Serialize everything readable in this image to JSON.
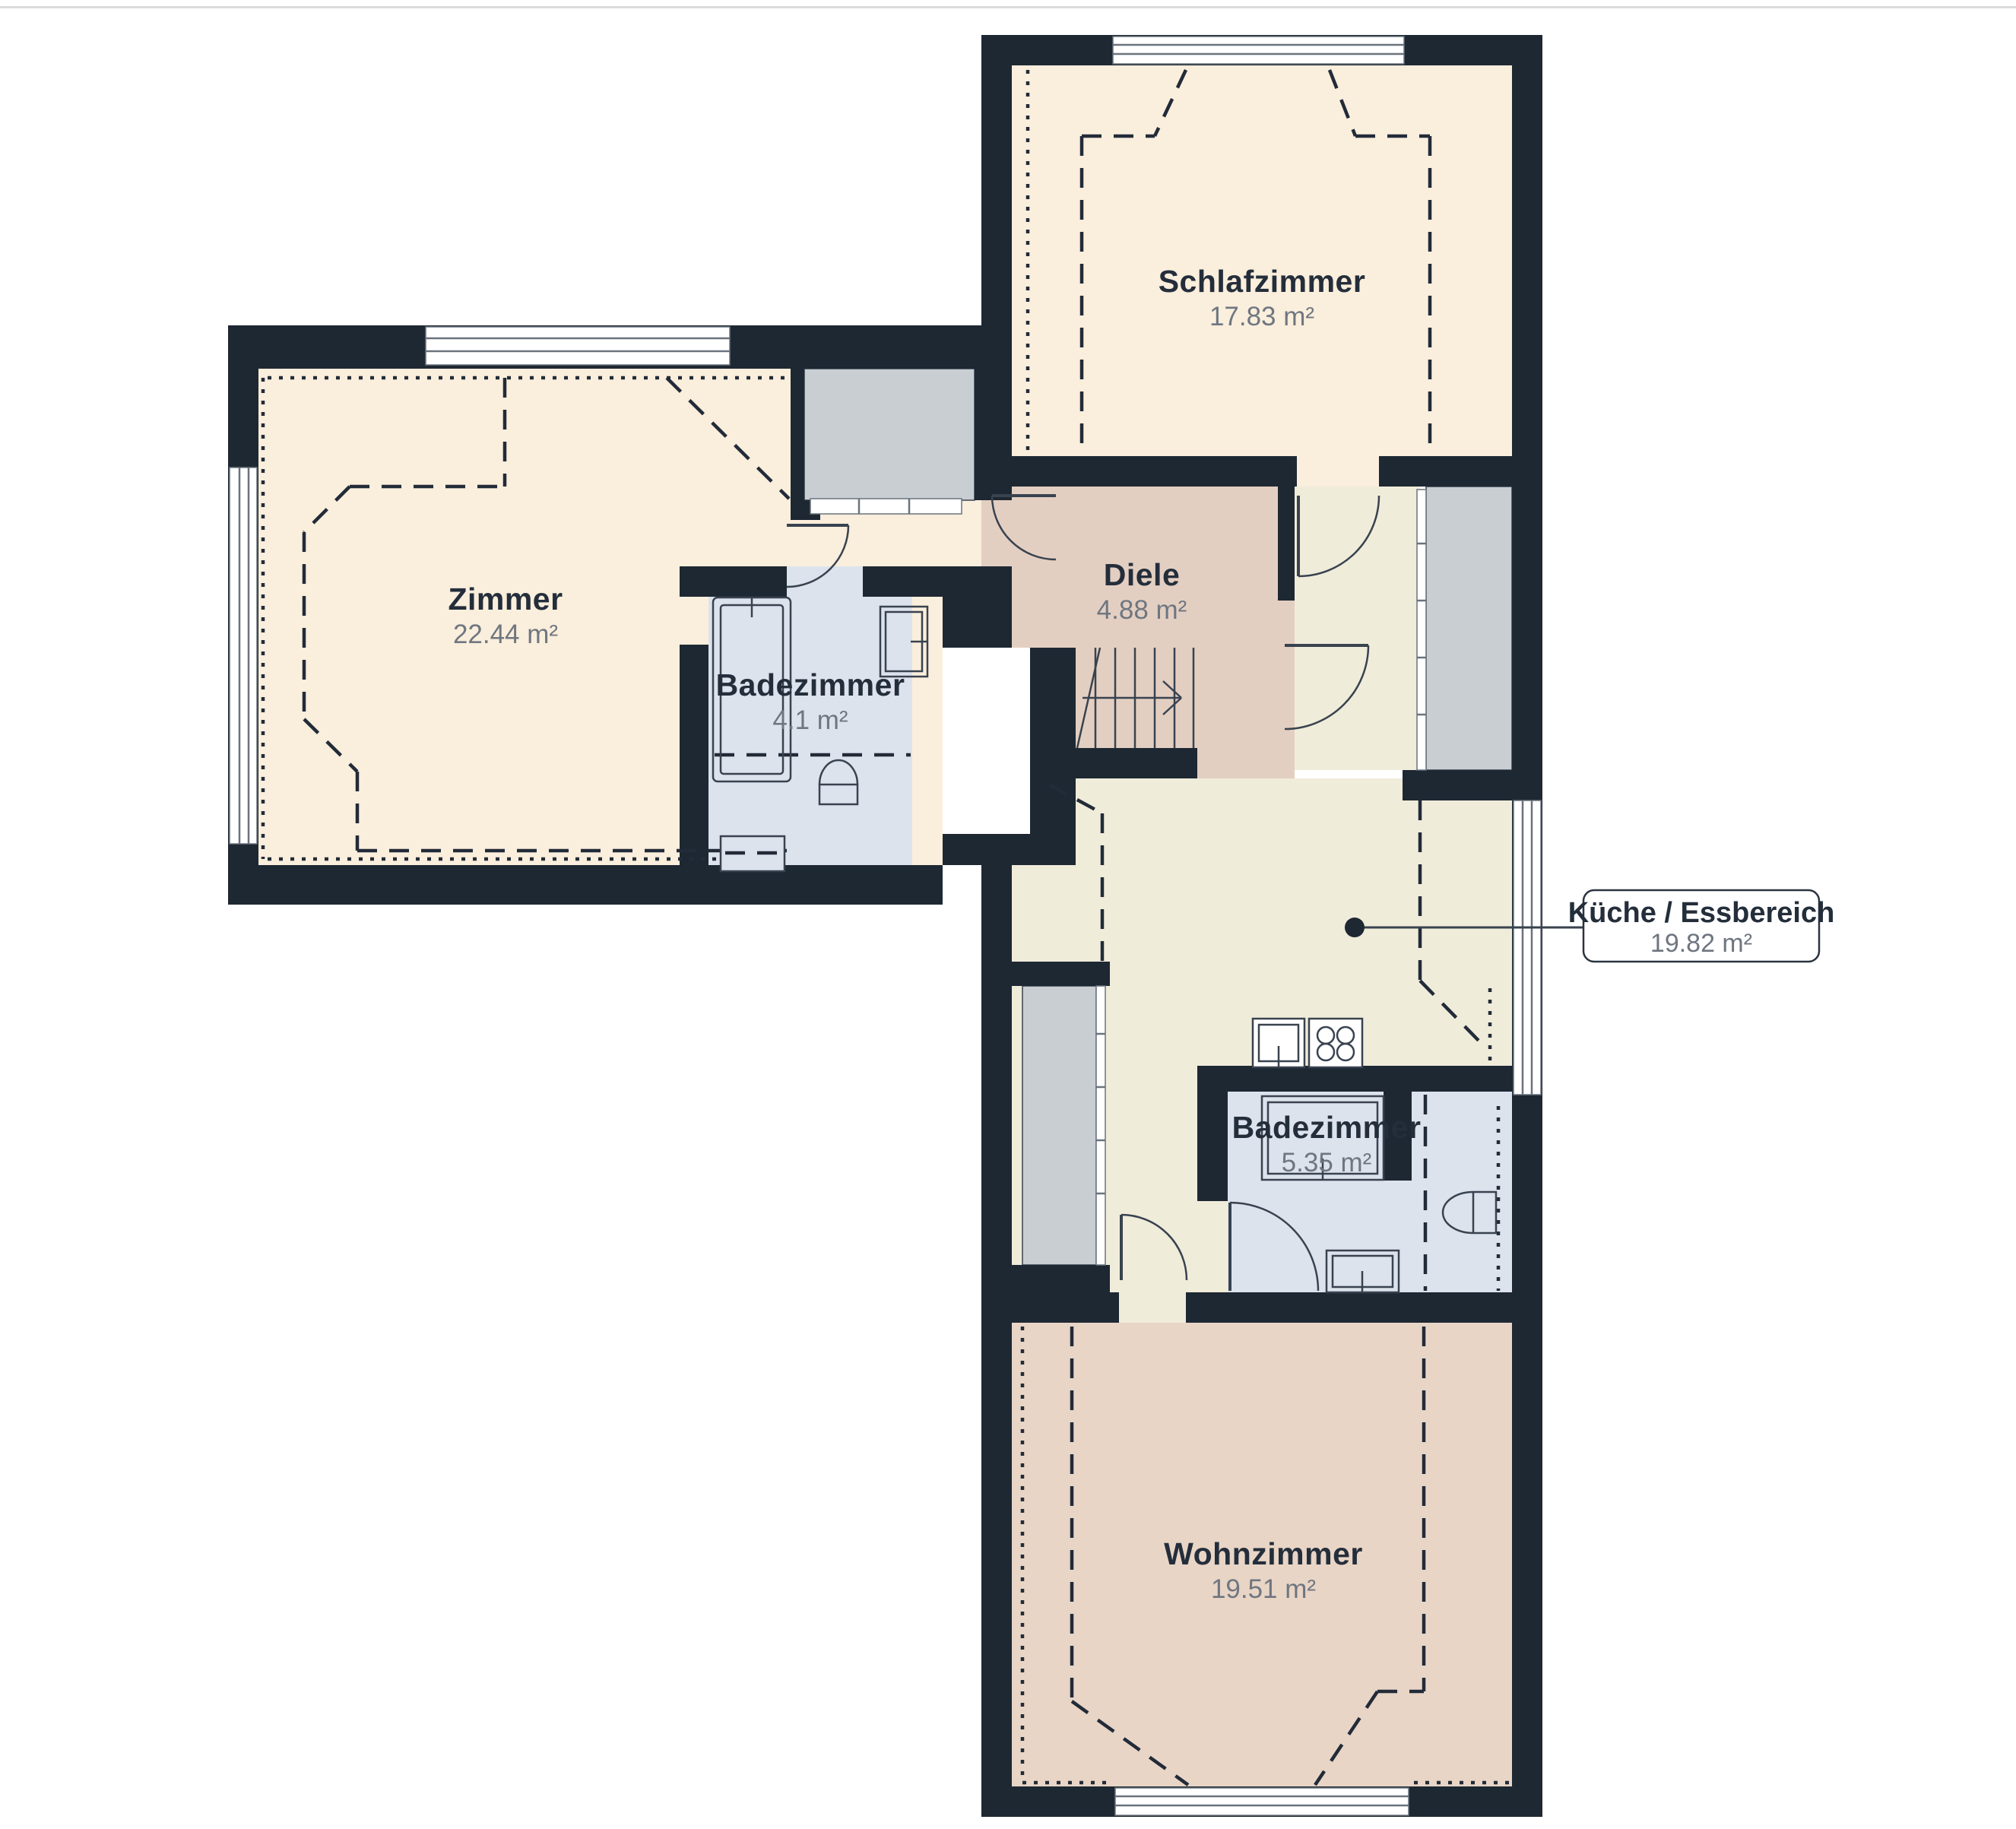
{
  "plan": {
    "title": "Wohnung Grundriss",
    "divider_color": "#d9dbdd",
    "colors": {
      "wall": "#1e2833",
      "room_peach": "#faeedc",
      "room_pink": "#e3cfc2",
      "room_cream": "#f0ecda",
      "room_blue": "#dce3ed",
      "room_tan": "#e8d5c6",
      "zone_gray": "#c9ced3",
      "text_dark": "#242e3b",
      "text_gray": "#6f7680"
    },
    "rooms": [
      {
        "id": "schlafzimmer",
        "name": "Schlafzimmer",
        "area": "17.83 m²"
      },
      {
        "id": "zimmer",
        "name": "Zimmer",
        "area": "22.44 m²"
      },
      {
        "id": "diele",
        "name": "Diele",
        "area": "4.88 m²"
      },
      {
        "id": "badezimmer-klein",
        "name": "Badezimmer",
        "area": "4.1 m²"
      },
      {
        "id": "kueche-essbereich",
        "name": "Küche / Essbereich",
        "area": "19.82 m²"
      },
      {
        "id": "badezimmer-gross",
        "name": "Badezimmer",
        "area": "5.35 m²"
      },
      {
        "id": "wohnzimmer",
        "name": "Wohnzimmer",
        "area": "19.51 m²"
      }
    ]
  }
}
